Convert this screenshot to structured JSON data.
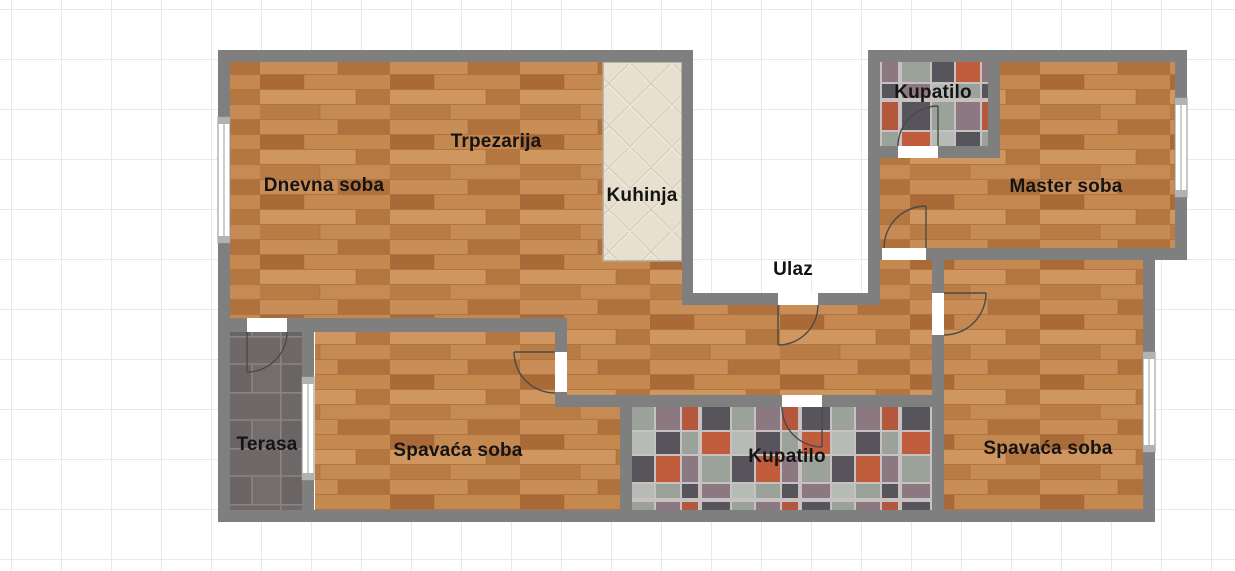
{
  "rooms": [
    {
      "id": "dnevna-soba",
      "label": "Dnevna soba"
    },
    {
      "id": "trpezarija",
      "label": "Trpezarija"
    },
    {
      "id": "kuhinja",
      "label": "Kuhinja"
    },
    {
      "id": "ulaz",
      "label": "Ulaz"
    },
    {
      "id": "kupatilo-gornje",
      "label": "Kupatilo"
    },
    {
      "id": "master-soba",
      "label": "Master soba"
    },
    {
      "id": "terasa",
      "label": "Terasa"
    },
    {
      "id": "spavaca-soba-1",
      "label": "Spavaća soba"
    },
    {
      "id": "kupatilo-donje",
      "label": "Kupatilo"
    },
    {
      "id": "spavaca-soba-2",
      "label": "Spavaća soba"
    }
  ],
  "colors": {
    "wall": "#7f7f7f",
    "wood_floor": "#c08550",
    "kitchen_tile": "#e7e0cf",
    "bathroom_grout": "#c7c1c1",
    "terrace_tile": "#6e6868",
    "grid_line": "#e7e9ee",
    "background": "#ffffff",
    "label_text": "#141414"
  }
}
